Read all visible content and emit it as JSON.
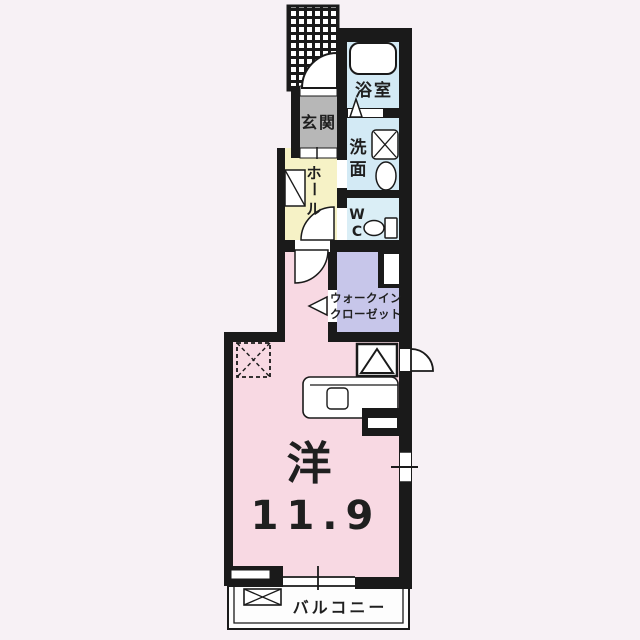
{
  "colors": {
    "background": "#f7f1f5",
    "wall": "#1a1a1a",
    "water_rooms": "#d3eaf5",
    "wc": "#daeef6",
    "genkan": "#b7b7b7",
    "hall": "#f6f2c6",
    "closet": "#c7c6ea",
    "living": "#f8d9e3",
    "balcony": "#fdfdfd",
    "fixture": "#ffffff",
    "text": "#1f1f1f"
  },
  "rooms": {
    "bath": {
      "label": "浴室"
    },
    "washroom": {
      "char1": "洗",
      "char2": "面"
    },
    "wc": {
      "line1": "W",
      "line2": "C"
    },
    "genkan": {
      "label": "玄関"
    },
    "hall": {
      "char1": "ホ",
      "char2": "ー",
      "char3": "ル"
    },
    "walk_in_closet": {
      "line1": "ウォークイン",
      "line2": "クローゼット"
    },
    "living": {
      "label": "洋",
      "size": "11.9"
    },
    "balcony": {
      "label": "バルコニー"
    }
  }
}
